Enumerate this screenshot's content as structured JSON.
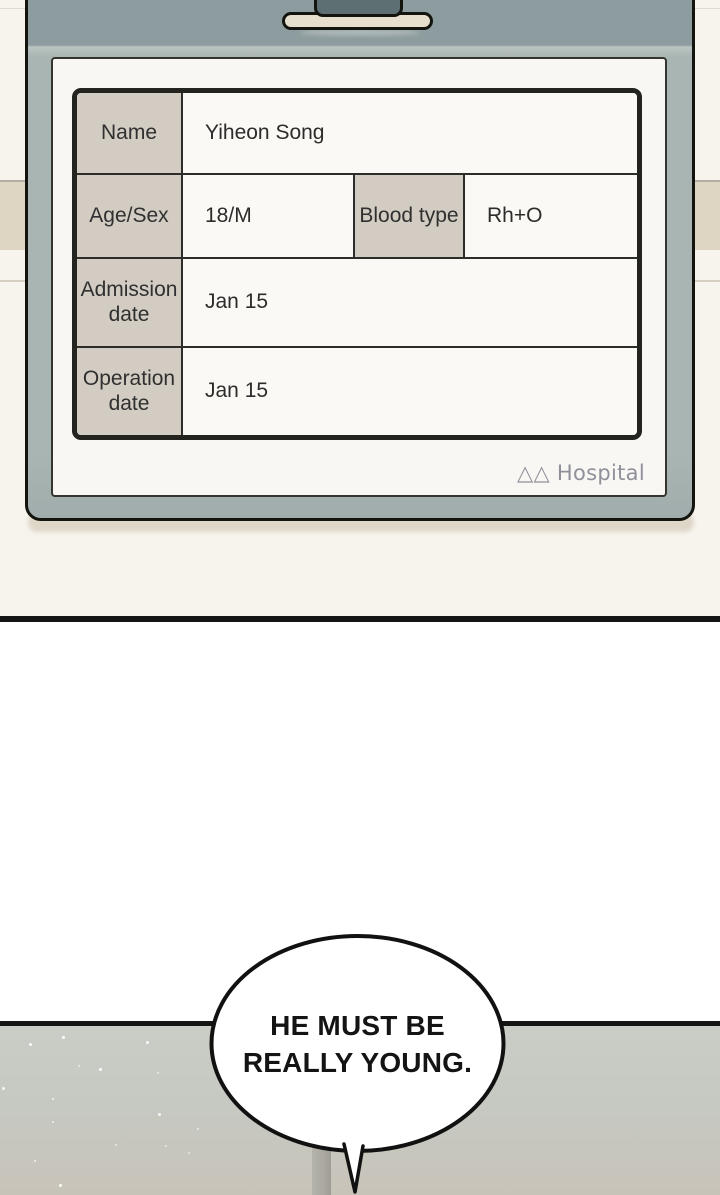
{
  "table": {
    "rows": [
      {
        "label": "Name",
        "value": "Yiheon Song"
      },
      {
        "label": "Age/Sex",
        "value": "18/M",
        "label2": "Blood type",
        "value2": "Rh+O"
      },
      {
        "label": "Admission date",
        "value": "Jan 15"
      },
      {
        "label": "Operation date",
        "value": "Jan 15"
      }
    ]
  },
  "footer": {
    "hospital": "△△ Hospital"
  },
  "bubble": {
    "line1": "HE MUST BE",
    "line2": "REALLY YOUNG."
  },
  "colors": {
    "clipboard_face": "#a9b5b3",
    "clipboard_top_band": "#8d9c9f",
    "clip_tab": "#5d6f72",
    "clip_bar": "#e7dfcd",
    "header_cell": "#d2ccc3",
    "paper": "#f9f7f3",
    "outline_black": "#14140f",
    "panel_top": "#cacdc6",
    "panel_bottom": "#c8c3b9",
    "hospital_text": "#90909b"
  }
}
